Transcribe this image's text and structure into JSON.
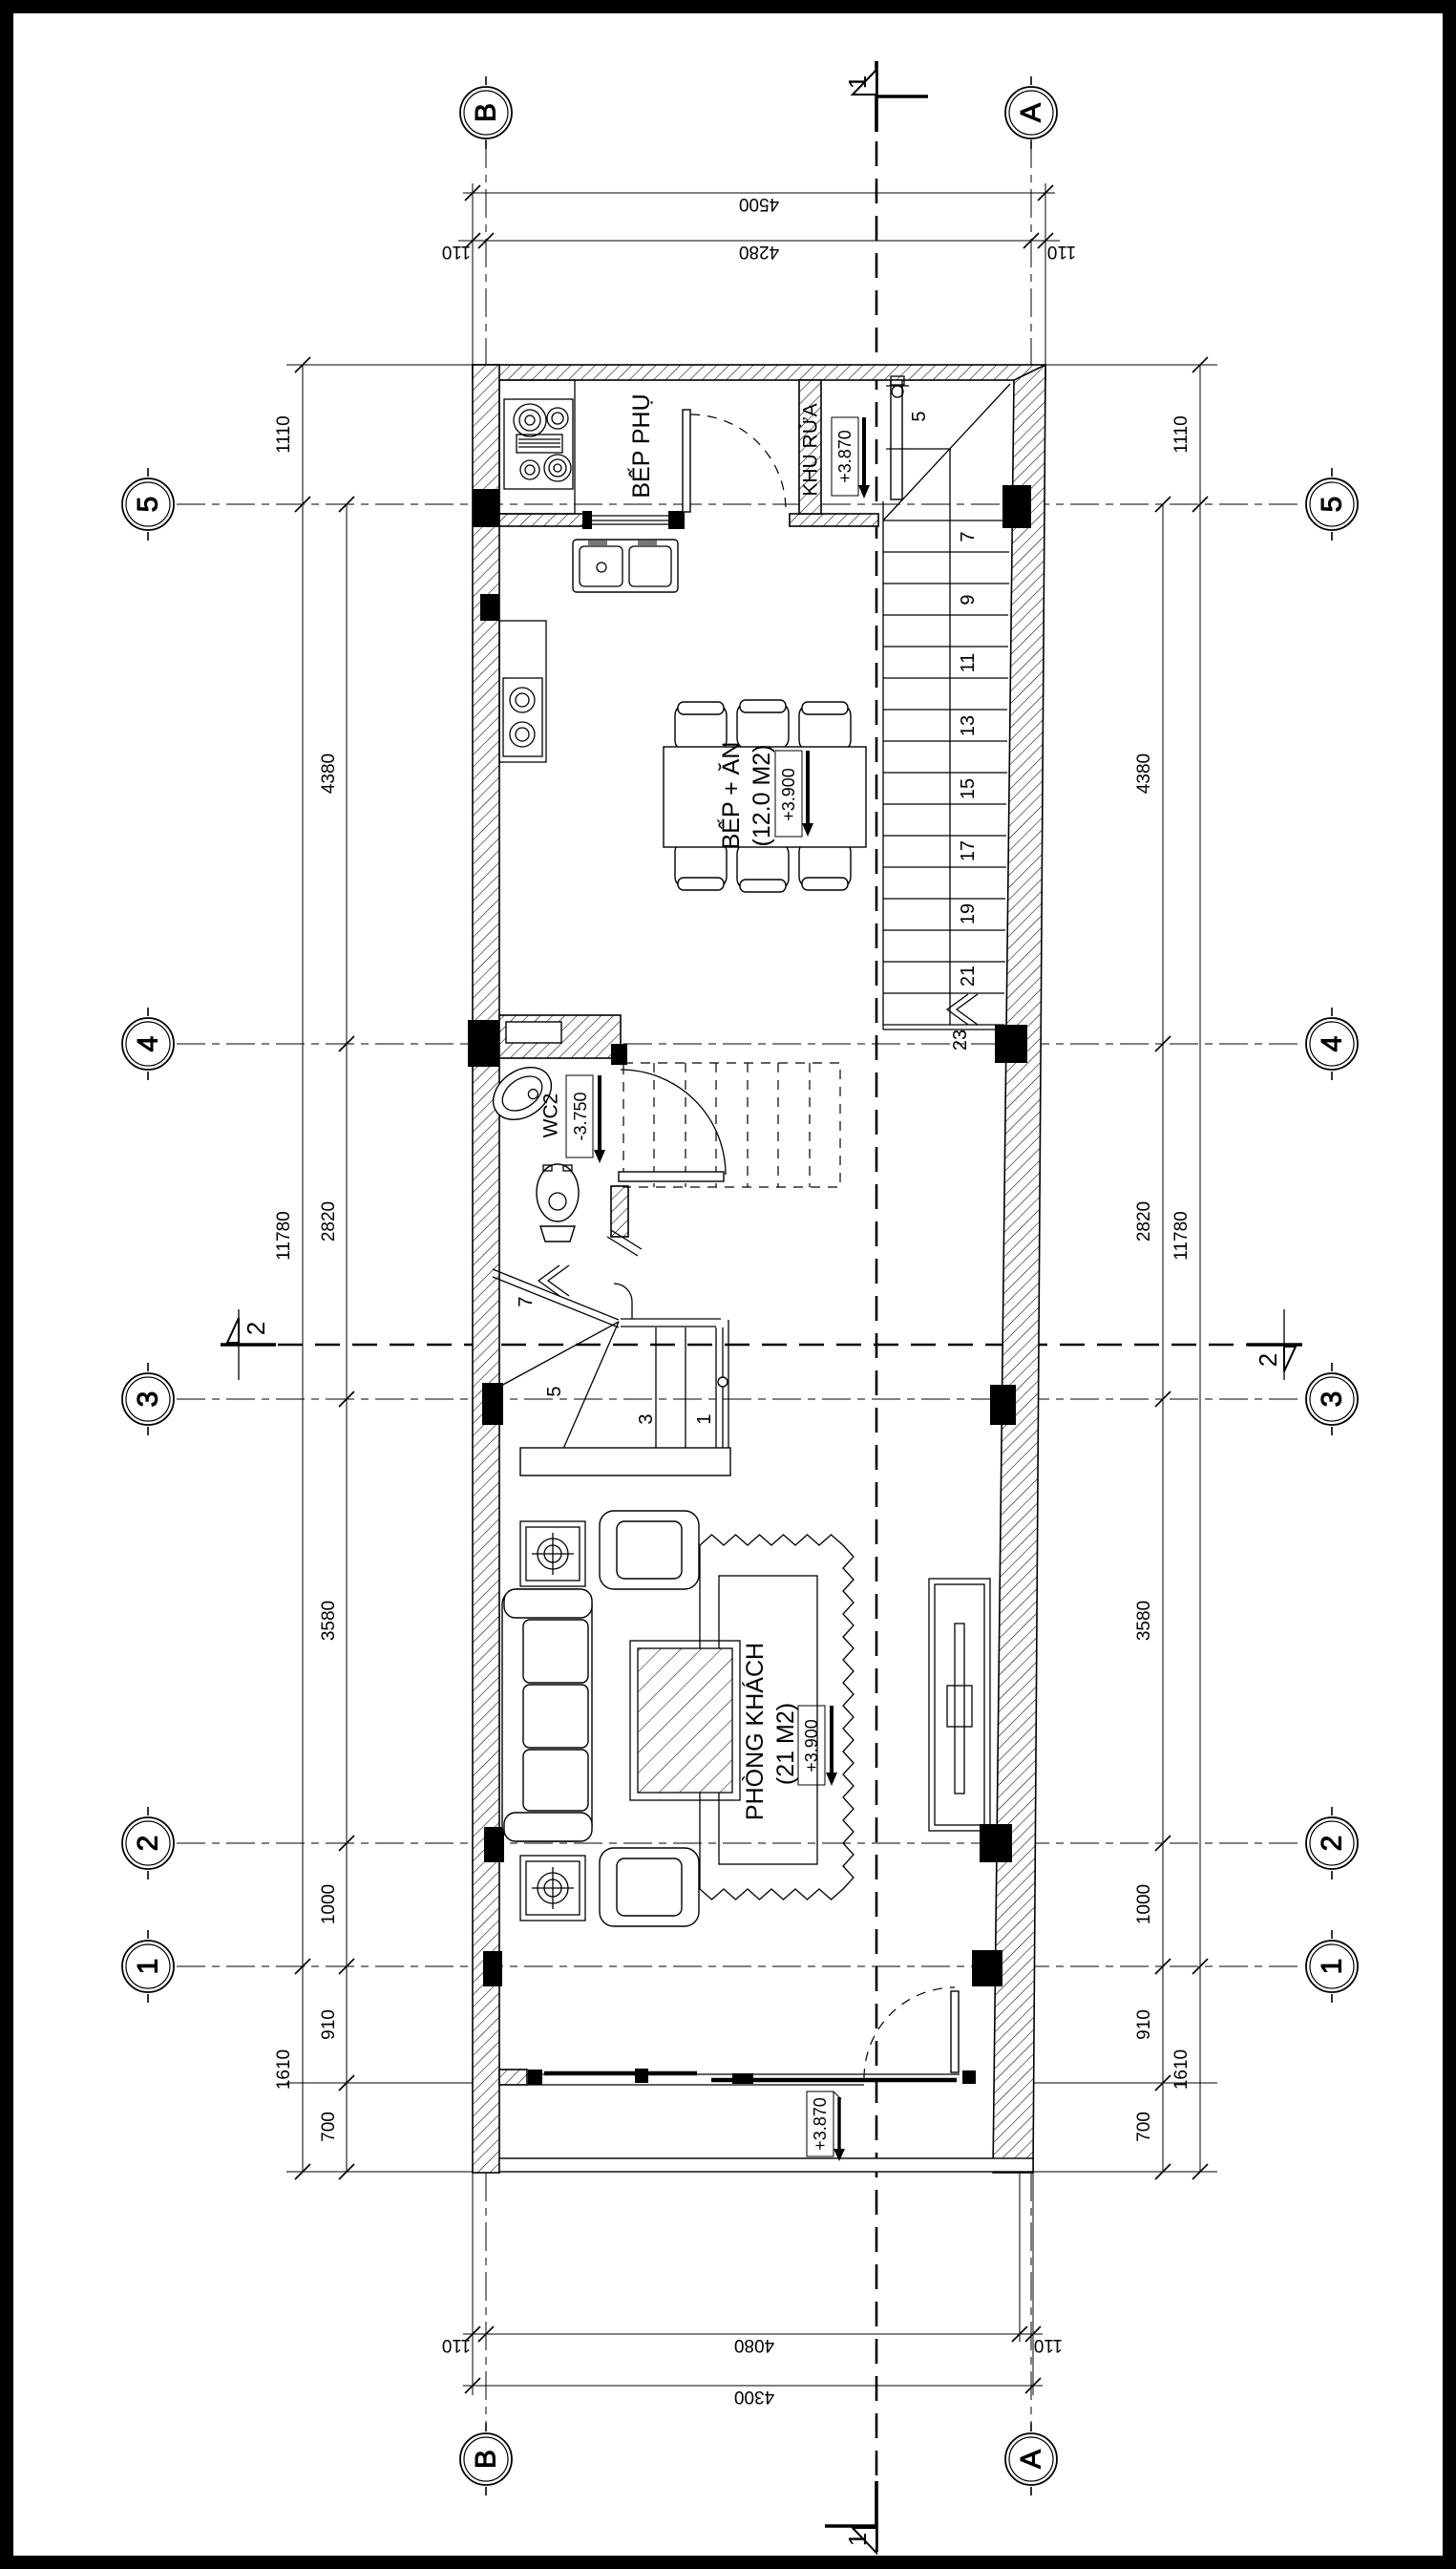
{
  "sheet": {
    "type": "floor-plan-drawing",
    "bg": "#ffffff",
    "line_color": "#000000"
  },
  "grid": {
    "cols": [
      {
        "label": "B"
      },
      {
        "label": "A"
      }
    ],
    "rows": [
      {
        "label": "5"
      },
      {
        "label": "4"
      },
      {
        "label": "3"
      },
      {
        "label": "2"
      },
      {
        "label": "1"
      }
    ]
  },
  "sections": {
    "s1": "1",
    "s2": "2"
  },
  "dims": {
    "top": {
      "total": "4500",
      "left_off": "110",
      "mid": "4280",
      "right_off": "110"
    },
    "bottom": {
      "left_off": "110",
      "mid": "4080",
      "right_off": "110",
      "total": "4300"
    },
    "left_outer": [
      "1110",
      "11780",
      "1610"
    ],
    "left_inner": [
      "4380",
      "2820",
      "3580",
      "1000",
      "910",
      "700"
    ],
    "right_outer": [
      "1110",
      "11780",
      "1610"
    ],
    "right_inner": [
      "4380",
      "2820",
      "3580",
      "1000",
      "910",
      "700"
    ]
  },
  "rooms": {
    "bep_phu": {
      "name": "BẾP PHỤ"
    },
    "khu_rua": {
      "name": "KHU RỬA",
      "level": "+3.870"
    },
    "bep_an": {
      "name": "BẾP + ĂN",
      "area": "(12.0 M2)",
      "level": "+3.900"
    },
    "wc2": {
      "name": "WC2",
      "level": "-3.750"
    },
    "phong_khach": {
      "name": "PHÒNG KHÁCH",
      "area": "(21 M2)",
      "level": "+3.900"
    },
    "balcony": {
      "level": "+3.870"
    }
  },
  "stairs": {
    "upper": [
      "5",
      "7",
      "9",
      "11",
      "13",
      "15",
      "17",
      "19",
      "21",
      "23"
    ],
    "lower": [
      "7",
      "5",
      "3",
      "1"
    ]
  }
}
